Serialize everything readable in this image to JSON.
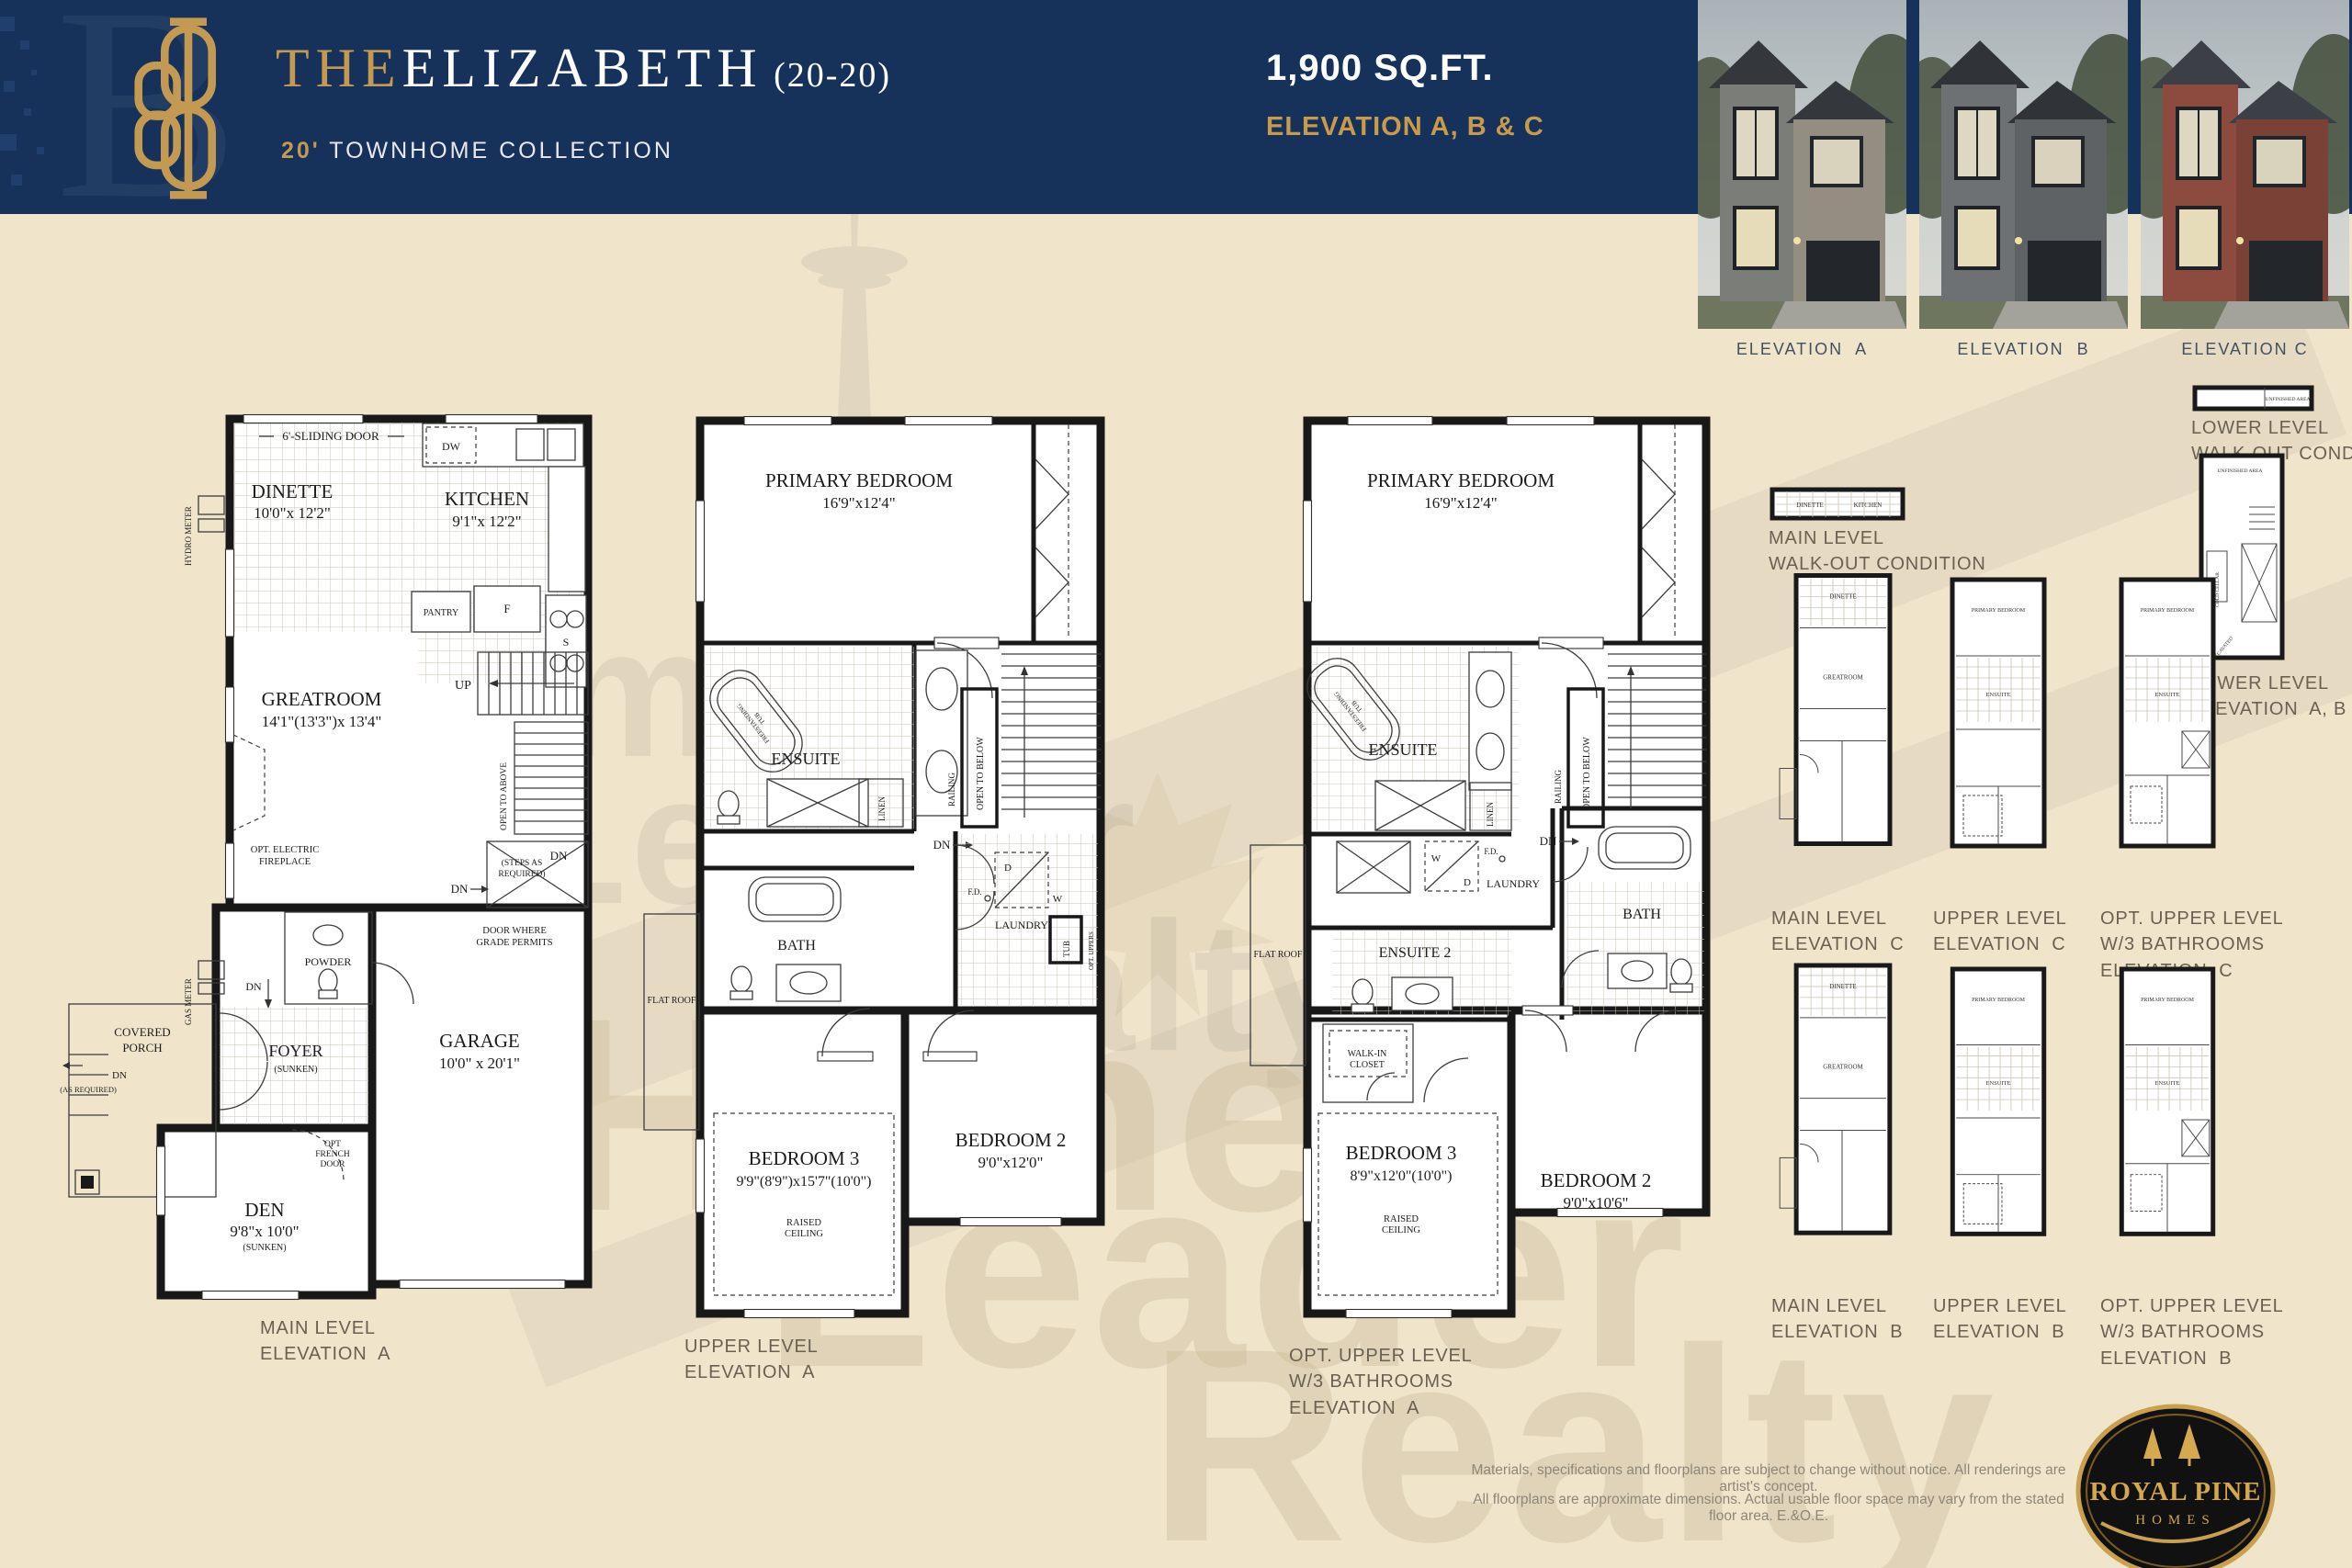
{
  "header": {
    "title_the": "THE",
    "title_name": "ELIZABETH",
    "title_suffix": " (20-20)",
    "subtitle_num": "20'",
    "subtitle_rest": " TOWNHOME COLLECTION",
    "sqft": "1,900 SQ.FT.",
    "elevation_line": "ELEVATION A, B & C"
  },
  "photos": {
    "labels": [
      "ELEVATION  A",
      "ELEVATION  B",
      "ELEVATION C"
    ]
  },
  "plan1": {
    "caption": [
      "MAIN LEVEL",
      "ELEVATION  A"
    ],
    "sliding_door": "6'-SLIDING DOOR",
    "dinette": "DINETTE",
    "dinette_dim": "10'0\"x 12'2\"",
    "kitchen": "KITCHEN",
    "kitchen_dim": "9'1\"x 12'2\"",
    "dw": "DW",
    "s": "S",
    "f": "F",
    "pantry": "PANTRY",
    "greatroom": "GREATROOM",
    "greatroom_dim": "14'1\"(13'3\")x 13'4\"",
    "fireplace": [
      "OPT. ELECTRIC",
      "FIREPLACE"
    ],
    "up": "UP",
    "open_to_above": "OPEN TO ABOVE",
    "dn": "DN",
    "steps_required": [
      "(STEPS AS",
      "REQUIRED)"
    ],
    "door_grade": [
      "DOOR WHERE",
      "GRADE PERMITS"
    ],
    "powder": "POWDER",
    "foyer": "FOYER",
    "sunken": "(SUNKEN)",
    "covered_porch": [
      "COVERED",
      "PORCH"
    ],
    "dn_as_required": [
      "DN",
      "(AS REQUIRED)"
    ],
    "garage": "GARAGE",
    "garage_dim": "10'0\" x 20'1\"",
    "opt_french_door": [
      "OPT",
      "FRENCH",
      "DOOR"
    ],
    "den": "DEN",
    "den_dim": "9'8\"x 10'0\"",
    "hydro_meter": "HYDRO METER",
    "gas_meter": "GAS METER"
  },
  "plan2": {
    "caption": [
      "UPPER LEVEL",
      "ELEVATION  A"
    ],
    "primary": "PRIMARY BEDROOM",
    "primary_dim": "16'9\"x12'4\"",
    "tub_label": [
      "FREESTANDING",
      "TUB"
    ],
    "ensuite": "ENSUITE",
    "linen": "LINEN",
    "railing": "RAILING",
    "open_to_below": "OPEN TO BELOW",
    "dn": "DN",
    "bath": "BATH",
    "flat_roof": "FLAT ROOF",
    "laundry": "LAUNDRY",
    "w": "W",
    "d": "D",
    "fd": "F.D.",
    "tub": "TUB",
    "opt_uppers": "OPT. UPPERS",
    "bed3": "BEDROOM 3",
    "bed3_dim": "9'9\"(8'9\")x15'7\"(10'0\")",
    "raised": [
      "RAISED",
      "CEILING"
    ],
    "bed2": "BEDROOM 2",
    "bed2_dim": "9'0\"x12'0\""
  },
  "plan3": {
    "caption": [
      "OPT. UPPER LEVEL",
      "W/3 BATHROOMS",
      "ELEVATION  A"
    ],
    "primary": "PRIMARY BEDROOM",
    "primary_dim": "16'9\"x12'4\"",
    "tub_label": [
      "FREESTANDING",
      "TUB"
    ],
    "ensuite": "ENSUITE",
    "ensuite2": "ENSUITE 2",
    "linen": "LINEN",
    "railing": "RAILING",
    "open_to_below": "OPEN TO BELOW",
    "dn": "DN",
    "bath": "BATH",
    "flat_roof": "FLAT ROOF",
    "laundry": "LAUNDRY",
    "w": "W",
    "d": "D",
    "fd": "F.D.",
    "walk_in": [
      "WALK-IN",
      "CLOSET"
    ],
    "bed3": "BEDROOM 3",
    "bed3_dim": "8'9\"x12'0\"(10'0\")",
    "raised": [
      "RAISED",
      "CEILING"
    ],
    "bed2": "BEDROOM 2",
    "bed2_dim": "9'0\"x10'6\""
  },
  "side": {
    "main_walkout": [
      "MAIN LEVEL",
      "WALK-OUT CONDITION"
    ],
    "lower_walkout": [
      "LOWER LEVEL",
      "WALK-OUT CONDITION"
    ],
    "lower_abc": [
      "LOWER LEVEL",
      "ELEVATION  A, B & C"
    ],
    "row1": [
      [
        "MAIN LEVEL",
        "ELEVATION  C"
      ],
      [
        "UPPER LEVEL",
        "ELEVATION  C"
      ],
      [
        "OPT. UPPER LEVEL",
        "W/3 BATHROOMS",
        "ELEVATION  C"
      ]
    ],
    "row2": [
      [
        "MAIN LEVEL",
        "ELEVATION  B"
      ],
      [
        "UPPER LEVEL",
        "ELEVATION  B"
      ],
      [
        "OPT. UPPER LEVEL",
        "W/3 BATHROOMS",
        "ELEVATION  B"
      ]
    ],
    "mini": {
      "dinette": "DINETTE",
      "kitchen": "KITCHEN",
      "greatroom": "GREATROOM",
      "primary": "PRIMARY BEDROOM",
      "ensuite": "ENSUITE",
      "cold_cellar": "COLD CELLAR",
      "unexcavated": "UNEXCAVATED",
      "unfinished": "UNFINISHED AREA"
    }
  },
  "footer": {
    "disclaimer1": "Materials, specifications and floorplans are subject to change without notice. All renderings are artist's concept.",
    "disclaimer2": "All floorplans are approximate dimensions. Actual usable floor space may vary from the stated floor area. E.&O.E.",
    "logo_name": "ROYAL PINE",
    "logo_homes": "HOMES"
  },
  "watermark": {
    "words": [
      "Home",
      "Leader",
      "Realty"
    ]
  },
  "colors": {
    "navy": "#16325b",
    "gold": "#c49a52",
    "cream": "#f0e4cb",
    "caption": "#6a6153"
  }
}
